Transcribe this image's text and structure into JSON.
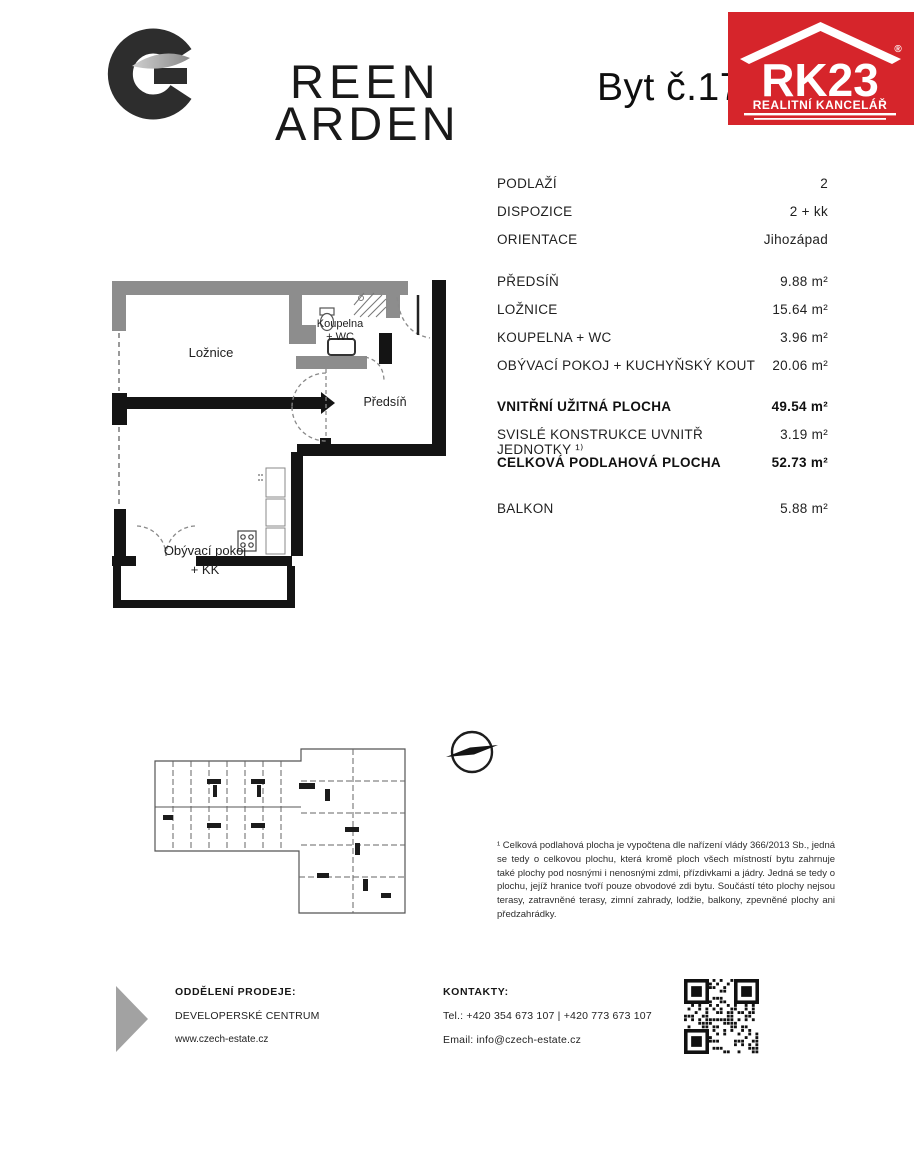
{
  "header": {
    "logo": {
      "name": "GREEN GARDEN",
      "line1": "REEN",
      "line2": "ARDEN"
    },
    "unit_title": "Byt č.17",
    "rk23": {
      "brand": "RK23",
      "registered": "®",
      "subtitle": "REALITNÍ KANCELÁŘ",
      "color": "#d6252b"
    }
  },
  "details": {
    "rows": [
      {
        "label": "PODLAŽÍ",
        "value": "2"
      },
      {
        "label": "DISPOZICE",
        "value": "2 + kk"
      },
      {
        "label": "ORIENTACE",
        "value": "Jihozápad"
      },
      {
        "label": "PŘEDSÍŇ",
        "value": "9.88 m²"
      },
      {
        "label": "LOŽNICE",
        "value": "15.64 m²"
      },
      {
        "label": "KOUPELNA + WC",
        "value": "3.96 m²"
      },
      {
        "label": "OBÝVACÍ POKOJ + KUCHYŇSKÝ KOUT",
        "value": "20.06 m²"
      },
      {
        "label": "VNITŘNÍ UŽITNÁ PLOCHA",
        "value": "49.54 m²"
      },
      {
        "label": "SVISLÉ KONSTRUKCE UVNITŘ JEDNOTKY ¹⁾",
        "value": "3.19 m²"
      },
      {
        "label": "CELKOVÁ PODLAHOVÁ PLOCHA",
        "value": "52.73 m²"
      },
      {
        "label": "BALKON",
        "value": "5.88 m²"
      }
    ]
  },
  "floorplan": {
    "bedroom": "Ložnice",
    "bathroom_line1": "Koupelna",
    "bathroom_line2": "+ WC",
    "hallway": "Předsíň",
    "living_line1": "Obývací pokoj",
    "living_line2": "+ KK"
  },
  "footnote": "¹ Celková podlahová plocha je vypočtena dle nařízení vlády 366/2013 Sb., jedná se tedy o celkovou plochu, která kromě ploch všech místností bytu zahrnuje také plochy pod nosnými i nenosnými zdmi, přízdivkami a jádry. Jedná se tedy o plochu, jejíž hranice tvoří pouze obvodové zdi bytu. Součástí této plochy nejsou terasy, zatravněné terasy, zimní zahrady, lodžie, balkony, zpevněné plochy ani předzahrádky.",
  "footer": {
    "sales_label": "ODDĚLENÍ PRODEJE:",
    "sales_name": "DEVELOPERSKÉ CENTRUM",
    "website": "www.czech-estate.cz",
    "contacts_label": "KONTAKTY:",
    "phone": "Tel.: +420 354 673 107 | +420 773 673 107",
    "email": "Email: info@czech-estate.cz"
  }
}
